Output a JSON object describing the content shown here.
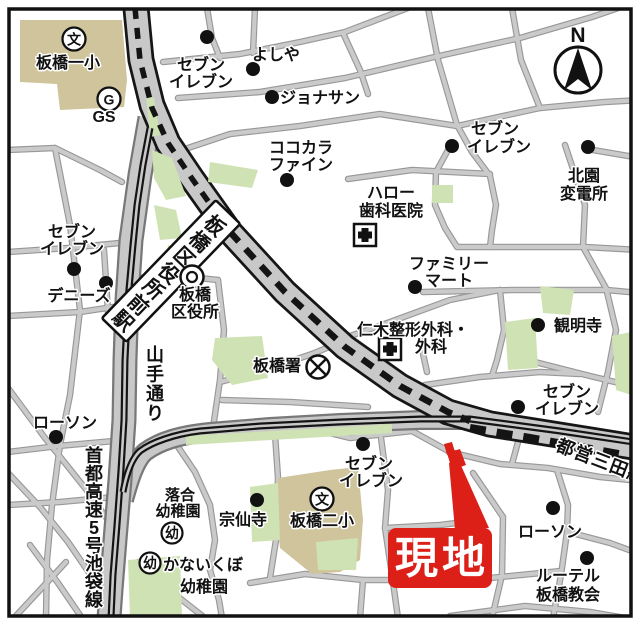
{
  "map": {
    "type": "real-estate location map",
    "site_label": "現地",
    "station_label": "板橋区役所前駅",
    "compass_label": "N"
  },
  "colors": {
    "road_fill": "#c8c8c8",
    "road_casing_major": "#161616",
    "road_casing_minor": "#787878",
    "street_casing": "#989898",
    "green_area": "#cfe2b4",
    "building_tan": "#cfc49b",
    "rail_black": "#141414",
    "site_red": "#dc2018",
    "background": "#ffffff"
  },
  "labels": {
    "north": "N",
    "genchi": "現地",
    "station": "板橋区役所前駅",
    "yamate": "山手通り",
    "shuto": "首都高速5号池袋線",
    "mita": "都営三田線",
    "school": "文",
    "kinder": "幼",
    "gas_g": "G",
    "gs": "GS",
    "itabashi1": "板橋一小",
    "itabashi2": "板橋二小",
    "seven1_l1": "セブン",
    "seven1_l2": "イレブン",
    "yoshiya": "よしや",
    "jonathan": "ジョナサン",
    "cocokara_l1": "ココカラ",
    "cocokara_l2": "ファイン",
    "seven2_l1": "セブン",
    "seven2_l2": "イレブン",
    "kitazono_l1": "北園",
    "kitazono_l2": "変電所",
    "hello_l1": "ハロー",
    "hello_l2": "歯科医院",
    "family_l1": "ファミリー",
    "family_l2": "マート",
    "niki_l1": "仁木整形外科・",
    "niki_l2": "外科",
    "kanmyoji": "観明寺",
    "seven3_l1": "セブン",
    "seven3_l2": "イレブン",
    "dennys": "デニーズ",
    "ward_l1": "板橋",
    "ward_l2": "区役所",
    "police": "板橋署",
    "lawson1": "ローソン",
    "ochiai_l1": "落合",
    "ochiai_l2": "幼稚園",
    "sosenji": "宗仙寺",
    "kanaikubo_l1": "かないくぼ",
    "kanaikubo_l2": "幼稚園",
    "seven4_l1": "セブン",
    "seven4_l2": "イレブン",
    "seven5_l1": "セブン",
    "seven5_l2": "イレブン",
    "lawson2": "ローソン",
    "lutheran_l1": "ルーテル",
    "lutheran_l2": "板橋教会"
  }
}
